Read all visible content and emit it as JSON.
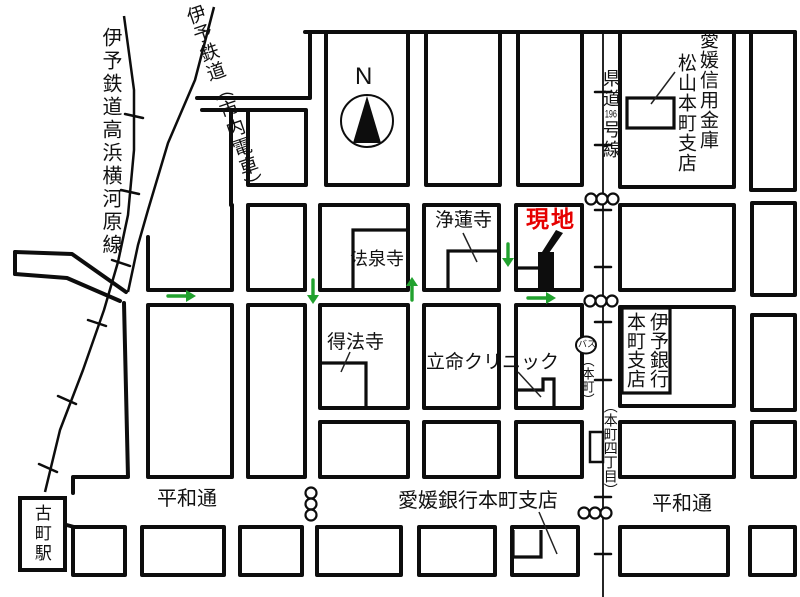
{
  "map": {
    "compass": {
      "north_label": "N"
    },
    "railways": {
      "takahama_line": "伊予鉄道高浜横河原線",
      "tram_line": "伊予鉄道（市内電車）"
    },
    "roads": {
      "kendo_prefix": "県道",
      "kendo_number": "196",
      "kendo_suffix": "号線",
      "heiwa_street_left": "平和通",
      "heiwa_street_right": "平和通",
      "honmachi_4_chome": "（本町四丁目）"
    },
    "stations": {
      "komachi_station": "古町駅",
      "bus_mark": "バス",
      "bus_stop_name": "（本町）"
    },
    "landmarks": {
      "site_label": "現地",
      "ehime_shinkin_line1": "愛媛信用金庫",
      "ehime_shinkin_line2": "松山本町支店",
      "jorenji_temple": "浄蓮寺",
      "hosenji_temple": "法泉寺",
      "tokuhoji_temple": "得法寺",
      "ritsumei_clinic": "立命クリニック",
      "iyo_bank_line1": "伊予銀行",
      "iyo_bank_line2": "本町支店",
      "ehime_bank": "愛媛銀行本町支店"
    },
    "colors": {
      "site_red": "#e60000",
      "arrow_green": "#21a12e",
      "line_black": "#0d0d0d"
    }
  }
}
